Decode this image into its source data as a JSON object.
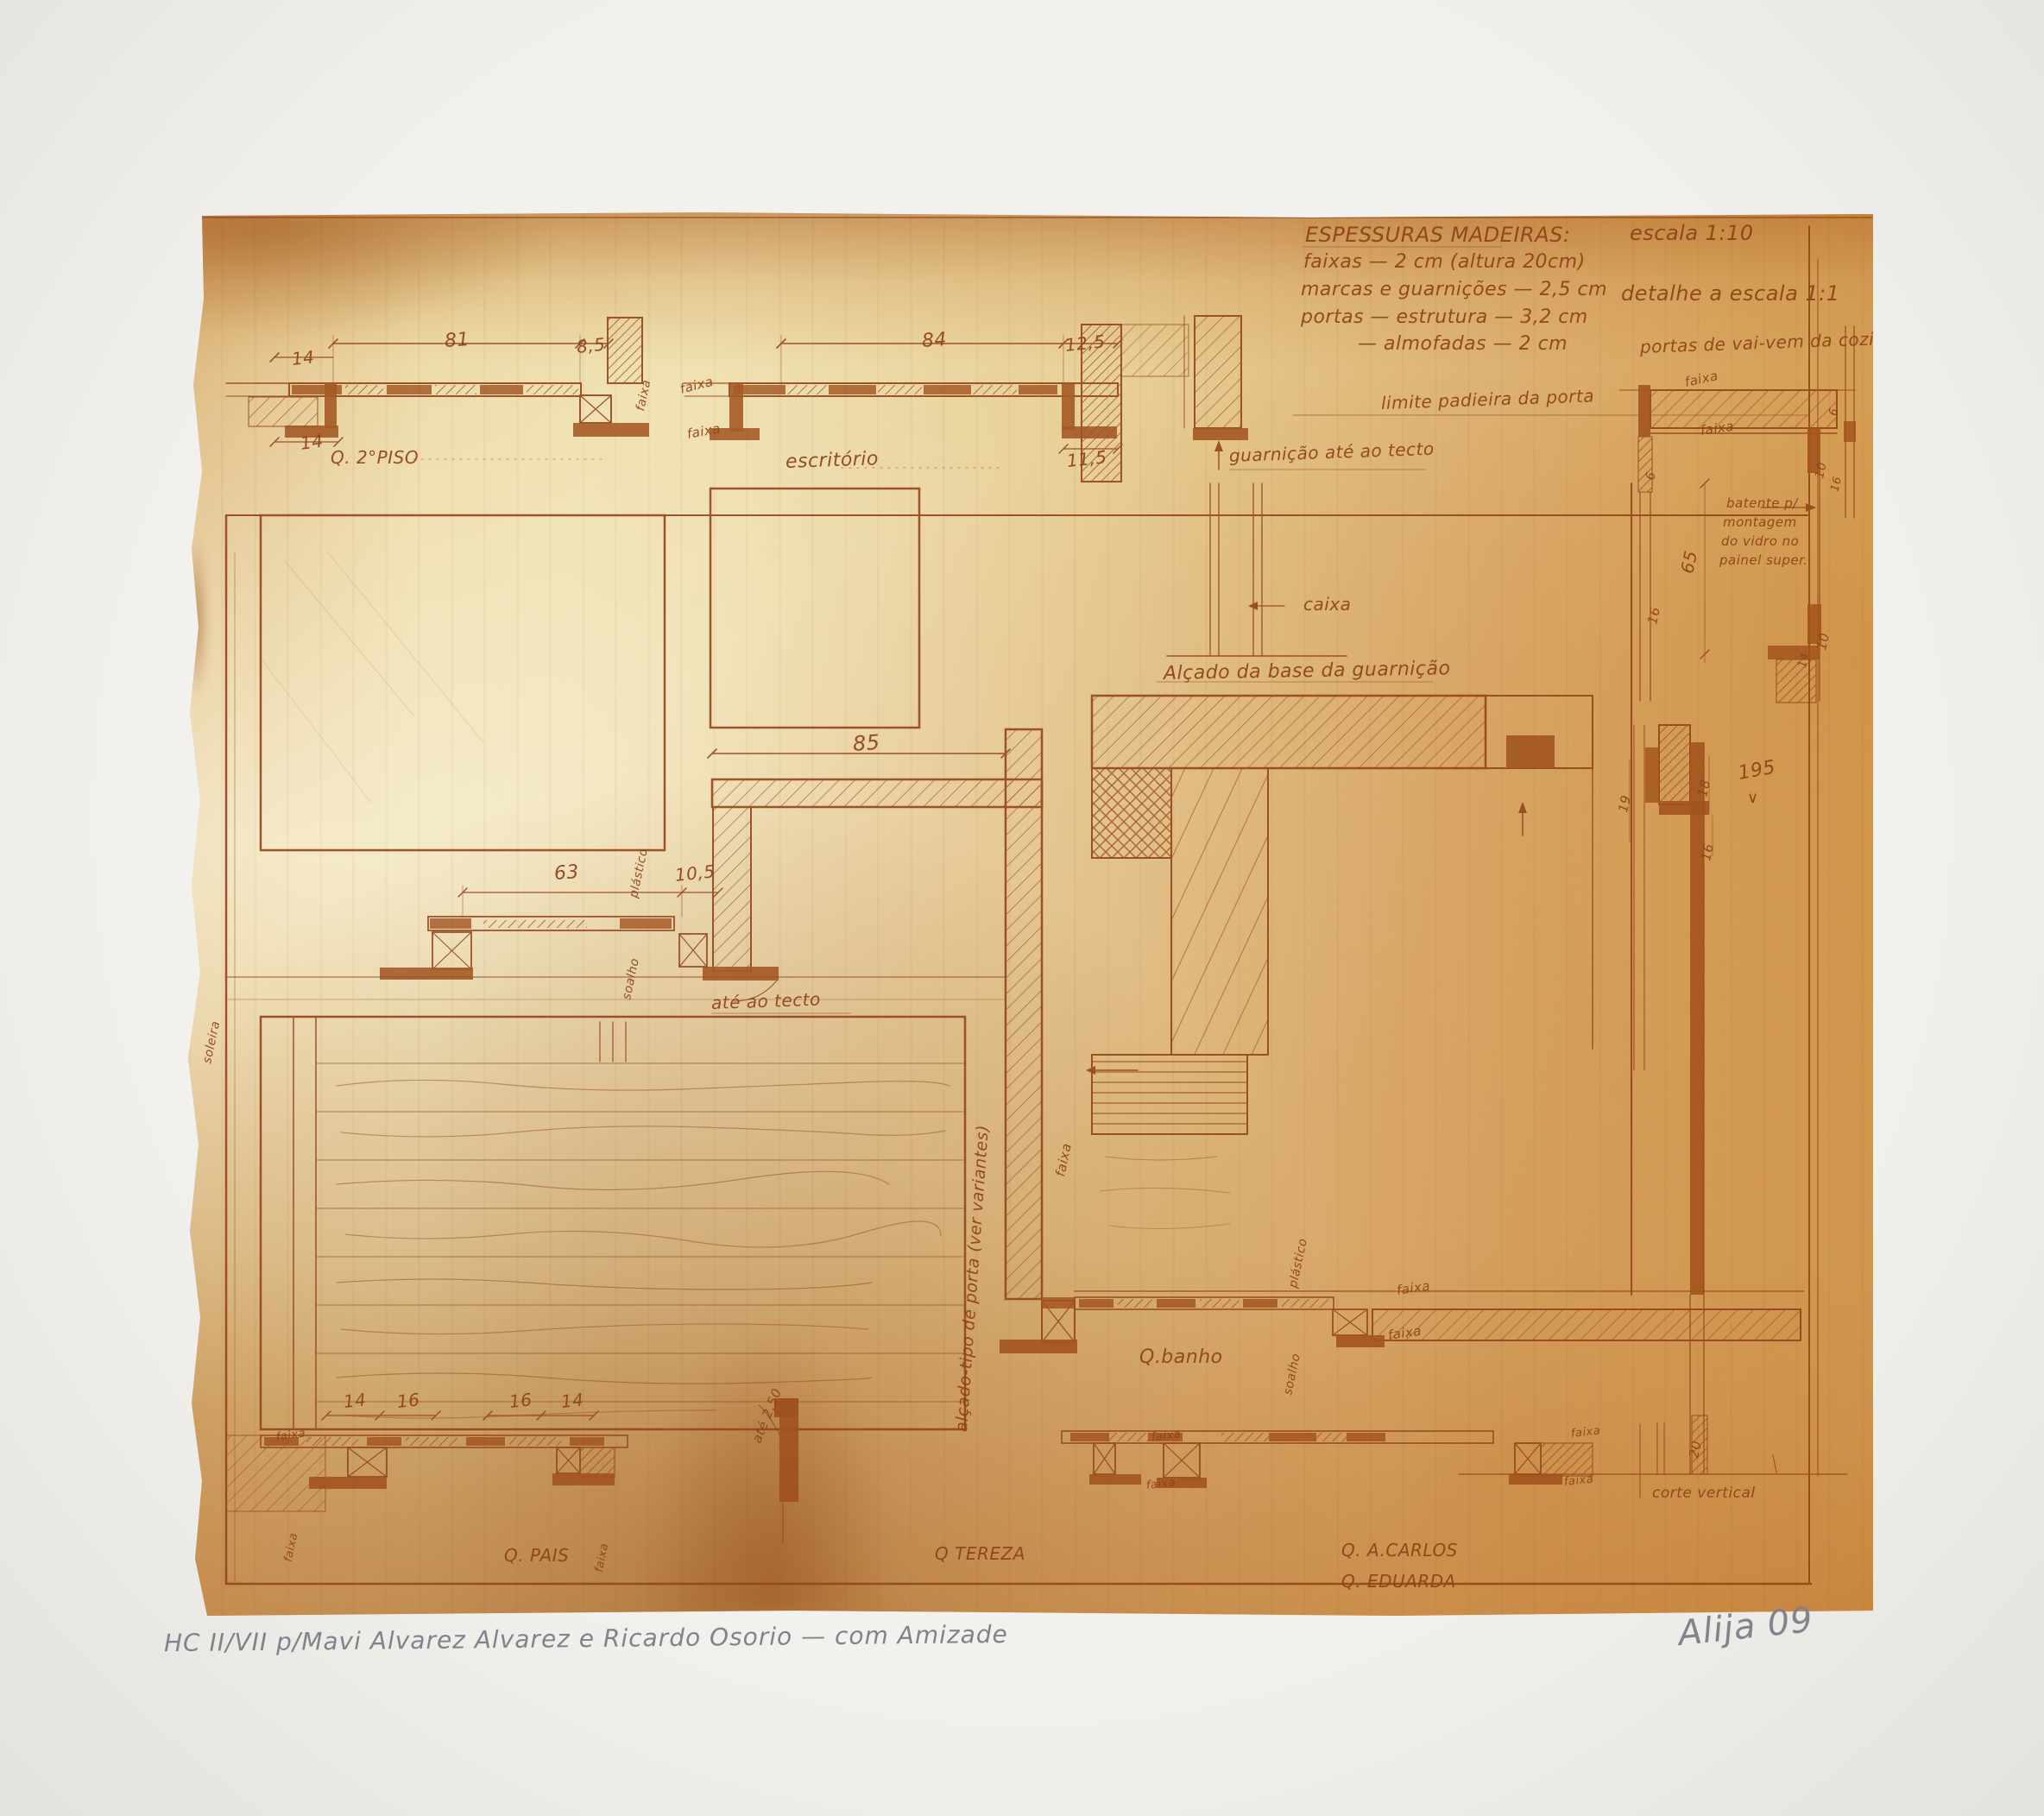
{
  "palette": {
    "ink": "#94451a",
    "ink_dark": "#9d4c18",
    "paper": "#ecd9a4",
    "mat": "#f1efec",
    "pencil": "#84808c"
  },
  "title_block": {
    "title": "ESPESSURAS MADEIRAS:",
    "specs": [
      "faixas — 2 cm (altura 20cm)",
      "marcas e guarnições — 2,5 cm",
      "portas — estrutura — 3,2 cm",
      "— almofadas — 2 cm"
    ],
    "scale": "escala 1:10",
    "detail_scale": "detalhe a escala 1:1"
  },
  "annotations": [
    "14",
    "81",
    "8,5",
    "14",
    "Q. 2°PISO",
    "faixa",
    "faixa",
    "faixa",
    "84",
    "12,5",
    "11,5",
    "escritório",
    "guarnição até ao tecto",
    "limite padieira da porta",
    "portas de vai-vem da cozinha",
    "faixa",
    "faixa",
    "batente p/",
    "montagem",
    "do vidro no",
    "painel super.",
    "65",
    "16",
    "10",
    "6",
    "10",
    "6",
    "16",
    "14",
    "caixa",
    "Alçado da base da guarnição",
    "85",
    "63",
    "10,5",
    "plástico",
    "soalho",
    "até ao tecto",
    "soleira",
    "alçado-tipo de porta (ver variantes)",
    "faixa",
    "19",
    "18",
    "195",
    "∨",
    "16",
    "plástico",
    "soalho",
    "faixa",
    "faixa",
    "Q.banho",
    "14",
    "16",
    "16",
    "14",
    "faixa",
    "faixa",
    "faixa",
    "até 2,50",
    "faixa",
    "faixa",
    "faixa",
    "faixa",
    "Q. PAIS",
    "Q TEREZA",
    "Q. A.CARLOS",
    "Q. EDUARDA",
    "corte vertical",
    "20"
  ],
  "edition": {
    "inscription": "HC II/VII  p/Mavi Alvarez Alvarez e Ricardo Osorio — com Amizade",
    "signature": "Alija  09"
  }
}
